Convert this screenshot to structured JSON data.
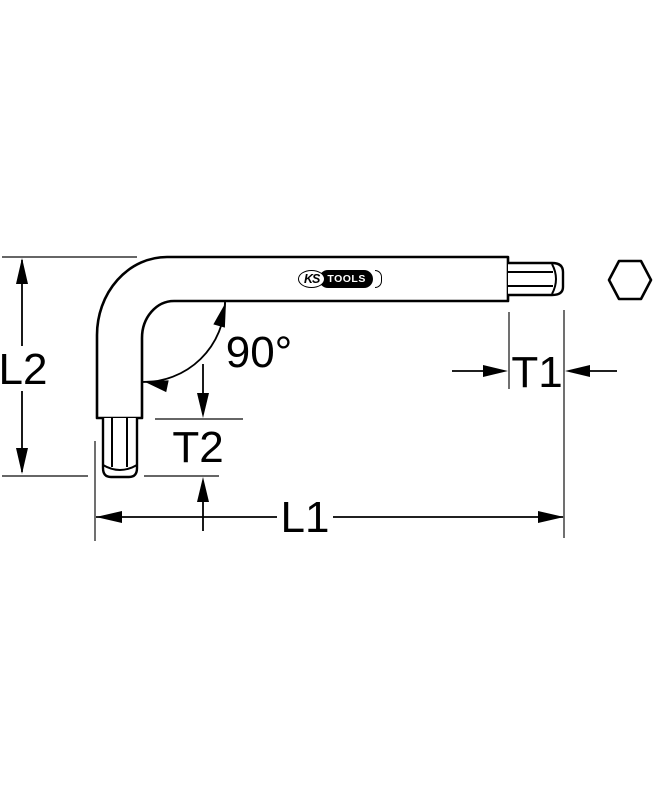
{
  "drawing": {
    "labels": {
      "l1": "L1",
      "l2": "L2",
      "t1": "T1",
      "t2": "T2",
      "angle": "90°"
    },
    "logo": {
      "ks": "KS",
      "tools": "TOOLS"
    },
    "colors": {
      "line": "#000000",
      "background": "#ffffff",
      "logo_background": "#000000",
      "logo_text": "#ffffff"
    }
  }
}
